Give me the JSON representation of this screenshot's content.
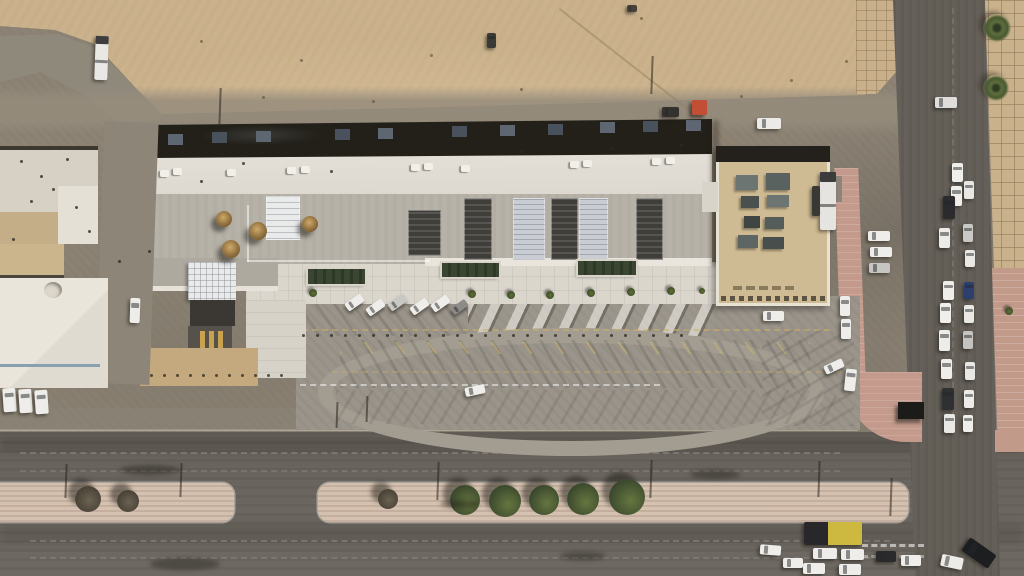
{
  "meta": {
    "title": "aerial-satellite-view-desert-commercial-plaza",
    "width": 1024,
    "height": 576
  },
  "palette": {
    "sand": "#cbb28c",
    "dirt": "#8c8375",
    "road": "#67625b",
    "median": "#d5c1b0",
    "brick": "#c39a8b",
    "sidewalk": "#c9b18c",
    "roof_white": "#e0dcd3",
    "roof_gray": "#b7b2a8",
    "roof_dark": "#232019",
    "roof_tan": "#cfbb93",
    "plaza": "#dad6cc",
    "tree_green": "#4c5c36",
    "tree_dry": "#5a5244",
    "car_white": "#eeede9",
    "bus_yellow": "#cdb93f",
    "dumpster_red": "#c14e35",
    "logo_gold": "#c8a24e"
  },
  "vehicles": [
    {
      "n": "truck",
      "x": 95,
      "y": 36,
      "w": 13,
      "h": 44,
      "c": "#e9e8e4",
      "r": 2,
      "seg": true
    },
    {
      "n": "car",
      "x": 487,
      "y": 33,
      "w": 9,
      "h": 15,
      "c": "#3c3a36",
      "r": 0
    },
    {
      "n": "car",
      "x": 627,
      "y": 5,
      "w": 10,
      "h": 7,
      "c": "#454239",
      "r": 0
    },
    {
      "n": "car",
      "x": 757,
      "y": 118,
      "w": 24,
      "h": 11,
      "c": "#ecebe8",
      "r": 0
    },
    {
      "n": "car",
      "x": 662,
      "y": 107,
      "w": 17,
      "h": 10,
      "c": "#34322e",
      "r": 0
    },
    {
      "n": "dumpster",
      "x": 692,
      "y": 100,
      "w": 15,
      "h": 15,
      "c": "#c14e35",
      "r": 0
    },
    {
      "n": "car",
      "x": 935,
      "y": 97,
      "w": 22,
      "h": 11,
      "c": "#dedddb",
      "r": 0
    },
    {
      "n": "car",
      "x": 952,
      "y": 163,
      "w": 11,
      "h": 19,
      "c": "#efeeea",
      "r": 0
    },
    {
      "n": "car",
      "x": 964,
      "y": 181,
      "w": 10,
      "h": 18,
      "c": "#e8e7e4",
      "r": 0
    },
    {
      "n": "car",
      "x": 951,
      "y": 186,
      "w": 11,
      "h": 20,
      "c": "#efeeeb",
      "r": 0
    },
    {
      "n": "suv",
      "x": 943,
      "y": 196,
      "w": 12,
      "h": 23,
      "c": "#2b2b2d",
      "r": 0
    },
    {
      "n": "car",
      "x": 963,
      "y": 224,
      "w": 10,
      "h": 18,
      "c": "#c9c8c5",
      "r": 0
    },
    {
      "n": "car",
      "x": 939,
      "y": 228,
      "w": 11,
      "h": 20,
      "c": "#ecebe8",
      "r": 0
    },
    {
      "n": "car",
      "x": 965,
      "y": 250,
      "w": 10,
      "h": 17,
      "c": "#e9e8e5",
      "r": 0
    },
    {
      "n": "car",
      "x": 943,
      "y": 281,
      "w": 11,
      "h": 19,
      "c": "#eeede9",
      "r": 0
    },
    {
      "n": "car",
      "x": 964,
      "y": 282,
      "w": 10,
      "h": 17,
      "c": "#2c3f6e",
      "r": 0
    },
    {
      "n": "car",
      "x": 940,
      "y": 303,
      "w": 11,
      "h": 20,
      "c": "#f0efeb",
      "r": 0
    },
    {
      "n": "car",
      "x": 964,
      "y": 305,
      "w": 10,
      "h": 18,
      "c": "#e9e8e4",
      "r": 0
    },
    {
      "n": "car",
      "x": 939,
      "y": 330,
      "w": 11,
      "h": 21,
      "c": "#edece8",
      "r": 0
    },
    {
      "n": "car",
      "x": 963,
      "y": 331,
      "w": 10,
      "h": 18,
      "c": "#c4c3c0",
      "r": 0
    },
    {
      "n": "car",
      "x": 941,
      "y": 359,
      "w": 11,
      "h": 20,
      "c": "#efeeea",
      "r": 0
    },
    {
      "n": "car",
      "x": 965,
      "y": 362,
      "w": 10,
      "h": 18,
      "c": "#e8e7e3",
      "r": 0
    },
    {
      "n": "suv",
      "x": 942,
      "y": 388,
      "w": 12,
      "h": 22,
      "c": "#2f3032",
      "r": 0
    },
    {
      "n": "car",
      "x": 964,
      "y": 390,
      "w": 10,
      "h": 18,
      "c": "#ecebe7",
      "r": 0
    },
    {
      "n": "car",
      "x": 944,
      "y": 414,
      "w": 11,
      "h": 19,
      "c": "#e9e8e4",
      "r": 0
    },
    {
      "n": "car",
      "x": 963,
      "y": 415,
      "w": 10,
      "h": 17,
      "c": "#efeeea",
      "r": 0
    },
    {
      "n": "car",
      "x": 868,
      "y": 231,
      "w": 22,
      "h": 10,
      "c": "#eeede9",
      "r": 0
    },
    {
      "n": "car",
      "x": 870,
      "y": 247,
      "w": 22,
      "h": 10,
      "c": "#eeede9",
      "r": 0
    },
    {
      "n": "car",
      "x": 869,
      "y": 263,
      "w": 21,
      "h": 10,
      "c": "#c6c5c2",
      "r": 0
    },
    {
      "n": "truck",
      "x": 820,
      "y": 172,
      "w": 16,
      "h": 58,
      "c": "#e5e4e0",
      "r": 0,
      "seg": true
    },
    {
      "n": "truck",
      "x": 812,
      "y": 186,
      "w": 8,
      "h": 30,
      "c": "#3a3835",
      "r": 0
    },
    {
      "n": "car",
      "x": 763,
      "y": 311,
      "w": 21,
      "h": 10,
      "c": "#eeede9",
      "r": 0
    },
    {
      "n": "car",
      "x": 345,
      "y": 298,
      "w": 19,
      "h": 9,
      "c": "#eeede9",
      "r": -35
    },
    {
      "n": "car",
      "x": 366,
      "y": 303,
      "w": 19,
      "h": 9,
      "c": "#eeede9",
      "r": -35
    },
    {
      "n": "car",
      "x": 388,
      "y": 298,
      "w": 19,
      "h": 9,
      "c": "#c9c8c4",
      "r": -35
    },
    {
      "n": "car",
      "x": 410,
      "y": 302,
      "w": 19,
      "h": 9,
      "c": "#eeede9",
      "r": -35
    },
    {
      "n": "car",
      "x": 431,
      "y": 299,
      "w": 19,
      "h": 9,
      "c": "#eeede9",
      "r": -35
    },
    {
      "n": "car",
      "x": 451,
      "y": 303,
      "w": 17,
      "h": 8,
      "c": "#8c8b88",
      "r": -35
    },
    {
      "n": "car",
      "x": 465,
      "y": 386,
      "w": 20,
      "h": 9,
      "c": "#efeeea",
      "r": -12
    },
    {
      "n": "car",
      "x": 840,
      "y": 296,
      "w": 10,
      "h": 20,
      "c": "#eeede9",
      "r": 0
    },
    {
      "n": "car",
      "x": 841,
      "y": 319,
      "w": 10,
      "h": 20,
      "c": "#eeede9",
      "r": 0
    },
    {
      "n": "car",
      "x": 845,
      "y": 369,
      "w": 11,
      "h": 22,
      "c": "#eeede9",
      "r": 6
    },
    {
      "n": "car",
      "x": 824,
      "y": 362,
      "w": 20,
      "h": 9,
      "c": "#eeede9",
      "r": -25
    },
    {
      "n": "van",
      "x": 3,
      "y": 388,
      "w": 13,
      "h": 24,
      "c": "#eeede9",
      "r": -4
    },
    {
      "n": "van",
      "x": 19,
      "y": 389,
      "w": 13,
      "h": 24,
      "c": "#eeede9",
      "r": -4
    },
    {
      "n": "van",
      "x": 35,
      "y": 390,
      "w": 13,
      "h": 24,
      "c": "#eeede9",
      "r": -4
    },
    {
      "n": "van",
      "x": 130,
      "y": 298,
      "w": 10,
      "h": 25,
      "c": "#eeede9",
      "r": 2
    },
    {
      "n": "bus",
      "x": 804,
      "y": 522,
      "w": 58,
      "h": 23,
      "c": "#cdb93f",
      "r": 0,
      "front": "#28282a"
    },
    {
      "n": "car",
      "x": 813,
      "y": 548,
      "w": 24,
      "h": 11,
      "c": "#eeede9",
      "r": 0
    },
    {
      "n": "car",
      "x": 841,
      "y": 549,
      "w": 23,
      "h": 11,
      "c": "#eeede9",
      "r": 0
    },
    {
      "n": "car",
      "x": 803,
      "y": 563,
      "w": 22,
      "h": 11,
      "c": "#eeede9",
      "r": 0
    },
    {
      "n": "car",
      "x": 839,
      "y": 564,
      "w": 22,
      "h": 11,
      "c": "#eeede9",
      "r": 0
    },
    {
      "n": "car",
      "x": 760,
      "y": 545,
      "w": 21,
      "h": 10,
      "c": "#eeede9",
      "r": 4
    },
    {
      "n": "car",
      "x": 783,
      "y": 558,
      "w": 20,
      "h": 10,
      "c": "#eeede9",
      "r": 0
    },
    {
      "n": "car",
      "x": 876,
      "y": 551,
      "w": 20,
      "h": 11,
      "c": "#2a2a2c",
      "r": 0
    },
    {
      "n": "car",
      "x": 901,
      "y": 555,
      "w": 20,
      "h": 11,
      "c": "#efeeea",
      "r": 0
    },
    {
      "n": "suv",
      "x": 963,
      "y": 545,
      "w": 32,
      "h": 16,
      "c": "#1d1e20",
      "r": 35
    },
    {
      "n": "car",
      "x": 941,
      "y": 556,
      "w": 22,
      "h": 12,
      "c": "#ecebe7",
      "r": 12
    }
  ],
  "trees": [
    {
      "x": 465,
      "y": 500,
      "r": 15,
      "k": "g"
    },
    {
      "x": 505,
      "y": 501,
      "r": 16,
      "k": "g"
    },
    {
      "x": 544,
      "y": 500,
      "r": 15,
      "k": "g"
    },
    {
      "x": 583,
      "y": 499,
      "r": 16,
      "k": "g"
    },
    {
      "x": 627,
      "y": 497,
      "r": 18,
      "k": "g"
    },
    {
      "x": 88,
      "y": 499,
      "r": 13,
      "k": "d"
    },
    {
      "x": 128,
      "y": 501,
      "r": 11,
      "k": "d"
    },
    {
      "x": 388,
      "y": 499,
      "r": 10,
      "k": "d"
    },
    {
      "x": 472,
      "y": 294,
      "r": 4,
      "k": "s"
    },
    {
      "x": 511,
      "y": 295,
      "r": 4,
      "k": "s"
    },
    {
      "x": 550,
      "y": 295,
      "r": 4,
      "k": "s"
    },
    {
      "x": 591,
      "y": 293,
      "r": 4,
      "k": "s"
    },
    {
      "x": 631,
      "y": 292,
      "r": 4,
      "k": "s"
    },
    {
      "x": 671,
      "y": 291,
      "r": 4,
      "k": "s"
    },
    {
      "x": 702,
      "y": 291,
      "r": 3,
      "k": "s"
    },
    {
      "x": 313,
      "y": 293,
      "r": 4,
      "k": "s"
    },
    {
      "x": 1009,
      "y": 311,
      "r": 4,
      "k": "s"
    }
  ],
  "palms": [
    {
      "x": 997,
      "y": 28,
      "r": 14
    },
    {
      "x": 996,
      "y": 88,
      "r": 13
    }
  ],
  "domes": [
    {
      "x": 224,
      "y": 219,
      "r": 8
    },
    {
      "x": 231,
      "y": 249,
      "r": 9
    },
    {
      "x": 258,
      "y": 231,
      "r": 9
    },
    {
      "x": 310,
      "y": 224,
      "r": 8
    }
  ],
  "planters": [
    {
      "x": 308,
      "y": 269,
      "w": 57,
      "h": 15
    },
    {
      "x": 442,
      "y": 263,
      "w": 57,
      "h": 14
    },
    {
      "x": 578,
      "y": 261,
      "w": 58,
      "h": 14
    }
  ],
  "skylights": [
    {
      "x": 464,
      "y": 198,
      "w": 28,
      "h": 62,
      "t": "d"
    },
    {
      "x": 551,
      "y": 198,
      "w": 27,
      "h": 62,
      "t": "d"
    },
    {
      "x": 636,
      "y": 198,
      "w": 27,
      "h": 62,
      "t": "d"
    },
    {
      "x": 408,
      "y": 210,
      "w": 33,
      "h": 46,
      "t": "d"
    },
    {
      "x": 513,
      "y": 198,
      "w": 32,
      "h": 62,
      "t": "l"
    },
    {
      "x": 579,
      "y": 198,
      "w": 29,
      "h": 62,
      "t": "l"
    },
    {
      "x": 266,
      "y": 196,
      "w": 34,
      "h": 44,
      "t": "g"
    }
  ],
  "ac_units": [
    [
      160,
      170
    ],
    [
      173,
      168
    ],
    [
      227,
      169
    ],
    [
      287,
      167
    ],
    [
      301,
      166
    ],
    [
      411,
      164
    ],
    [
      424,
      163
    ],
    [
      461,
      165
    ],
    [
      570,
      161
    ],
    [
      583,
      160
    ],
    [
      652,
      158
    ],
    [
      666,
      157
    ]
  ],
  "north_boxes": [
    [
      168,
      134
    ],
    [
      212,
      132
    ],
    [
      256,
      131
    ],
    [
      335,
      129
    ],
    [
      378,
      128
    ],
    [
      452,
      126
    ],
    [
      500,
      125
    ],
    [
      548,
      124
    ],
    [
      600,
      122
    ],
    [
      643,
      121
    ],
    [
      686,
      120
    ]
  ],
  "sq_equipment": [
    {
      "x": 736,
      "y": 175,
      "w": 22,
      "h": 15,
      "c": "#6c7572"
    },
    {
      "x": 766,
      "y": 173,
      "w": 24,
      "h": 17,
      "c": "#59625f"
    },
    {
      "x": 741,
      "y": 196,
      "w": 18,
      "h": 12,
      "c": "#49504d"
    },
    {
      "x": 767,
      "y": 195,
      "w": 22,
      "h": 12,
      "c": "#6c7572"
    },
    {
      "x": 744,
      "y": 216,
      "w": 16,
      "h": 12,
      "c": "#3f4543"
    },
    {
      "x": 765,
      "y": 217,
      "w": 19,
      "h": 12,
      "c": "#545d5a"
    },
    {
      "x": 738,
      "y": 235,
      "w": 20,
      "h": 13,
      "c": "#5d6663"
    },
    {
      "x": 763,
      "y": 237,
      "w": 21,
      "h": 12,
      "c": "#474e4b"
    }
  ],
  "poles": [
    [
      219,
      88,
      40
    ],
    [
      651,
      56,
      38
    ],
    [
      65,
      464,
      34
    ],
    [
      180,
      463,
      34
    ],
    [
      437,
      462,
      38
    ],
    [
      650,
      460,
      38
    ],
    [
      818,
      461,
      36
    ],
    [
      890,
      478,
      38
    ],
    [
      366,
      396,
      26
    ],
    [
      336,
      402,
      26
    ]
  ],
  "dot_rows": [
    {
      "x": 302,
      "y": 334,
      "n": 28,
      "s": 14,
      "w": 3,
      "h": 3,
      "c": "rgba(40,37,30,.75)",
      "round": true,
      "name": "bollard-row-plaza"
    },
    {
      "x": 150,
      "y": 374,
      "n": 11,
      "s": 13,
      "w": 3,
      "h": 3,
      "c": "rgba(40,37,30,.75)",
      "round": true,
      "name": "bollard-row-west"
    },
    {
      "x": 721,
      "y": 296,
      "n": 12,
      "s": 9,
      "w": 5,
      "h": 5,
      "c": "#5c5344",
      "round": false,
      "name": "parapet-crenellation"
    },
    {
      "x": 733,
      "y": 286,
      "n": 5,
      "s": 13,
      "w": 9,
      "h": 4,
      "c": "#8a7a5c",
      "round": false,
      "name": "roof-markings"
    }
  ],
  "specks": [
    [
      20,
      160
    ],
    [
      40,
      175
    ],
    [
      66,
      158
    ],
    [
      30,
      200
    ],
    [
      75,
      206
    ],
    [
      52,
      188
    ],
    [
      12,
      238
    ],
    [
      88,
      230
    ],
    [
      330,
      170
    ],
    [
      520,
      150
    ],
    [
      610,
      147
    ],
    [
      680,
      144
    ],
    [
      200,
      180
    ],
    [
      242,
      162
    ],
    [
      700,
      130
    ],
    [
      148,
      250
    ],
    [
      118,
      260
    ]
  ],
  "sand_debris": [
    [
      262,
      96
    ],
    [
      300,
      59
    ],
    [
      430,
      54
    ],
    [
      520,
      88
    ],
    [
      790,
      79
    ],
    [
      845,
      60
    ],
    [
      640,
      17
    ],
    [
      200,
      40
    ],
    [
      740,
      95
    ],
    [
      372,
      100
    ]
  ],
  "road_smudges": [
    {
      "x": 150,
      "y": 558,
      "w": 70,
      "h": 12
    },
    {
      "x": 440,
      "y": 500,
      "w": 40,
      "h": 8
    },
    {
      "x": 690,
      "y": 470,
      "w": 50,
      "h": 9
    },
    {
      "x": 120,
      "y": 465,
      "w": 60,
      "h": 10
    },
    {
      "x": 560,
      "y": 552,
      "w": 46,
      "h": 8
    }
  ]
}
